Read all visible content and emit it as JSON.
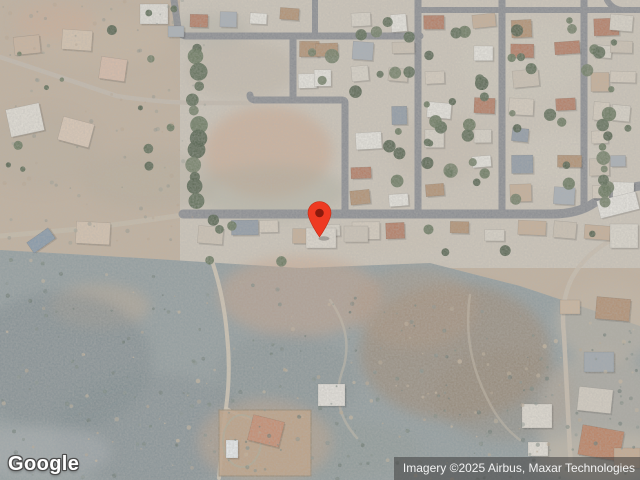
{
  "map": {
    "view_type": "satellite",
    "pin": {
      "color": "#EE3A22",
      "dot_color": "#8A1A0D"
    }
  },
  "footer": {
    "logo_text": "Google",
    "attribution_text": "Imagery ©2025 Airbus, Maxar Technologies"
  }
}
